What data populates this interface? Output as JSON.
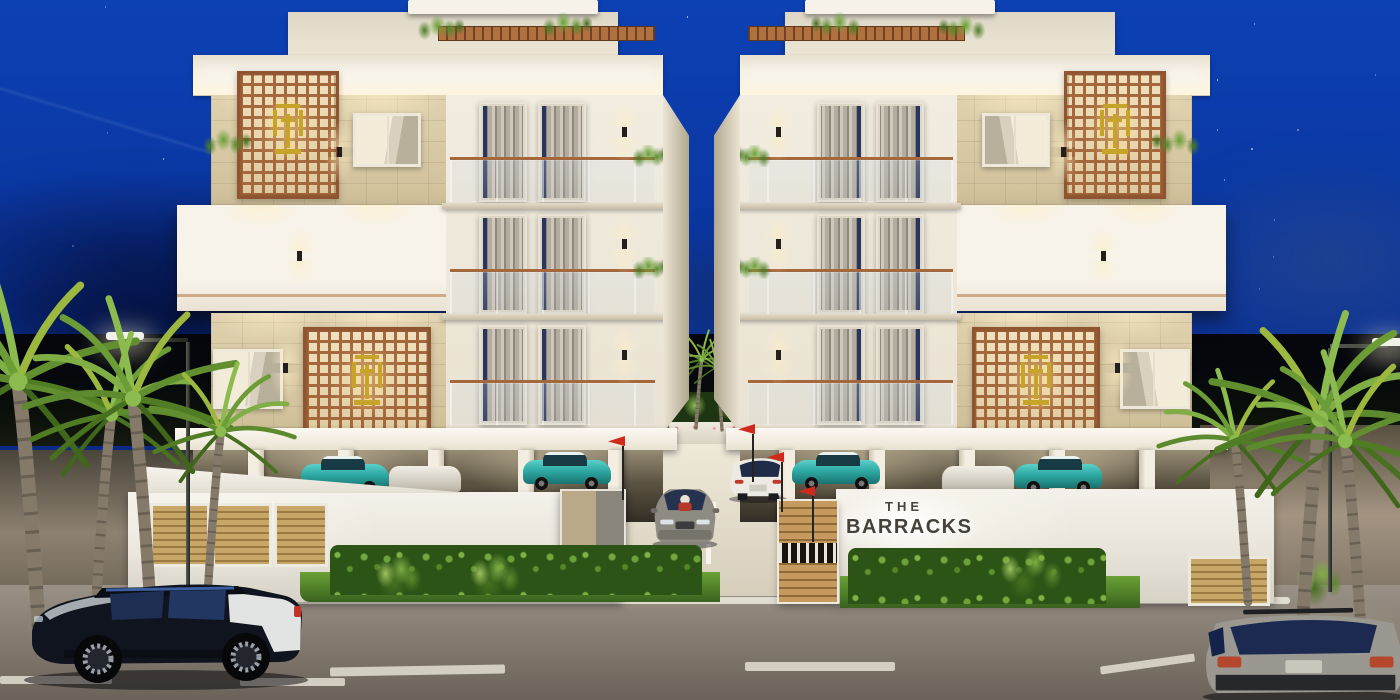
{
  "meta": {
    "scene_type": "architectural 3D night render",
    "subject": "modern residential apartment complex with central gated driveway"
  },
  "signage": {
    "line1": "THE",
    "line2": "BARRACKS"
  },
  "sky": {
    "description": "deep royal-blue night sky with scattered stars and low clouds",
    "star_count": 40
  },
  "palette": {
    "sky_top": "#0c41b4",
    "sky_mid": "#0b2f8e",
    "sky_horizon": "#0a1e5c",
    "building_white": "#f2ede1",
    "fascia_white": "#f6f2e8",
    "stone_beige": "#e0d2ae",
    "lattice_copper": "#a5673c",
    "emblem_gold": "#c6a429",
    "rail_copper": "#b57440",
    "curtain_grey": "#a9a399",
    "road_taupe": "#8e857a",
    "driveway_concrete": "#e5decd",
    "grass_green": "#4c7c27",
    "hedge_green": "#2c5416",
    "palm_green": "#6d9434",
    "teal_car": "#2fa9a4",
    "navy_suv": "#131726",
    "grey_suv": "#9a9890",
    "flag_red": "#d02a1c",
    "gate_wood": "#b78d52",
    "sign_text": "#46413a"
  },
  "scene": {
    "buildings": {
      "count": 2,
      "arrangement": "mirrored pair flanking central driveway",
      "features": "white facades, beige stone tile walls, copper fretwork screens with gold emblems, glass balconies with copper handrails, grey curtains, warm up/down sconces, rooftop planters, ground-level parking on pillars"
    },
    "vehicles": [
      {
        "type": "suv",
        "color": "navy-black with white rear quarter",
        "view": "side",
        "location": "street foreground left"
      },
      {
        "type": "suv",
        "color": "grey-silver",
        "view": "rear",
        "location": "street foreground right"
      },
      {
        "type": "sedan",
        "color": "grey",
        "view": "front, driver visible",
        "location": "central driveway"
      },
      {
        "type": "suv",
        "color": "white",
        "view": "rear three-quarter",
        "location": "central driveway"
      },
      {
        "type": "hatchback",
        "color": "teal",
        "view": "side",
        "location": "under-building parking, both sides"
      }
    ],
    "landscape": {
      "palm_trees": "clusters at left and right street edges plus small palms in rear courtyard",
      "hedges": "trimmed hedge rows in front of boundary walls",
      "lawn": "green strips along sidewalk"
    },
    "entrance": {
      "gate_pillar": "wooden slat pillar with striped band",
      "flags": "small red pennants on posts",
      "boundary_wall": "white wall with backlit project sign"
    },
    "lighting": {
      "street_lamps": 2,
      "mood": "warm interior glow against blue night"
    }
  }
}
